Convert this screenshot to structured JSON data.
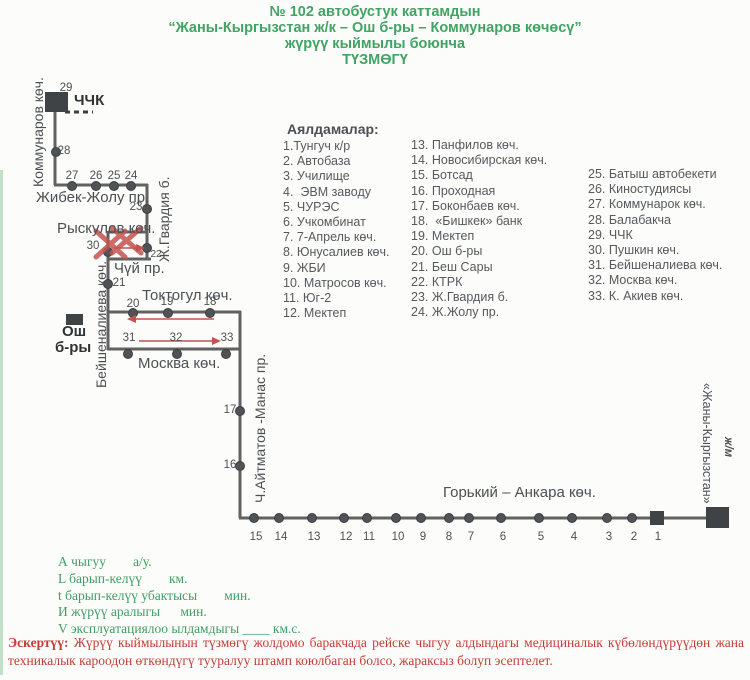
{
  "title": {
    "line1": "№ 102 автобустук каттамдын",
    "line2": "“Жаны-Кыргызстан ж/к – Ош б-ры – Коммунаров көчөсү”",
    "line3": "жүрүү кыймылы боюнча",
    "line4": "ТҮЗМӨГҮ"
  },
  "colors": {
    "title_green": "#3fa464",
    "legend_green": "#3f9e63",
    "note_red": "#c43c36",
    "route_gray": "#616161",
    "mark_red": "#c4524e"
  },
  "stops_header": "Аялдамалар:",
  "stops_col1": [
    "1.Тунгуч к/р",
    "2. Автобаза",
    "3. Училище",
    "4.  ЭВМ заводу",
    "5. ЧУРЭС",
    "6. Учкомбинат",
    "7. 7-Апрель көч.",
    "8. Юнусалиев көч.",
    "9. ЖБИ",
    "10. Матросов көч.",
    "11. Юг-2",
    "12. Мектеп"
  ],
  "stops_col2": [
    "13. Панфилов көч.",
    "14. Новосибирская көч.",
    "15. Ботсад",
    "16. Проходная",
    "17. Боконбаев көч.",
    "18.  «Бишкек» банк",
    "19. Мектеп",
    "20. Ош б-ры",
    "21. Беш Сары",
    "22. КТРК",
    "23. Ж.Гвардия б.",
    "24. Ж.Жолу пр."
  ],
  "stops_col3": [
    "25. Батыш автобекети",
    "26. Киностудиясы",
    "27. Коммунарок көч.",
    "28. Балабакча",
    "29. ЧЧК",
    "30. Пушкин көч.",
    "31. Бейшеналиева көч.",
    "32. Москва көч.",
    "33. К. Акиев көч."
  ],
  "map_labels": [
    {
      "t": "29",
      "x": 66,
      "y": 82,
      "c": "num"
    },
    {
      "t": "ЧЧК",
      "x": 74,
      "y": 92,
      "c": "terminal",
      "n": "terminal-label-chchk"
    },
    {
      "t": "28",
      "x": 64,
      "y": 145,
      "c": "num"
    },
    {
      "t": "27",
      "x": 72,
      "y": 170,
      "c": "num"
    },
    {
      "t": "26",
      "x": 96,
      "y": 170,
      "c": "num"
    },
    {
      "t": "25",
      "x": 114,
      "y": 170,
      "c": "num"
    },
    {
      "t": "24",
      "x": 131,
      "y": 170,
      "c": "num"
    },
    {
      "t": "Жибек-Жолу пр.",
      "x": 36,
      "y": 189,
      "c": "street",
      "n": "street-label-zhibek-zholu"
    },
    {
      "t": "23",
      "x": 136,
      "y": 201,
      "c": "num"
    },
    {
      "t": "Рыскулов көч.",
      "x": 57,
      "y": 220,
      "c": "street",
      "n": "street-label-ryskulov"
    },
    {
      "t": "30",
      "x": 93,
      "y": 240,
      "c": "num"
    },
    {
      "t": "22",
      "x": 156,
      "y": 249,
      "c": "num num-sm"
    },
    {
      "t": "Чүй пр.",
      "x": 114,
      "y": 260,
      "c": "street",
      "n": "street-label-chuy"
    },
    {
      "t": "21",
      "x": 119,
      "y": 277,
      "c": "num"
    },
    {
      "t": "Токтогул көч.",
      "x": 142,
      "y": 287,
      "c": "street",
      "n": "street-label-toktogul"
    },
    {
      "t": "20",
      "x": 133,
      "y": 298,
      "c": "num"
    },
    {
      "t": "19",
      "x": 167,
      "y": 296,
      "c": "num"
    },
    {
      "t": "18",
      "x": 210,
      "y": 296,
      "c": "num"
    },
    {
      "t": "31",
      "x": 129,
      "y": 332,
      "c": "num"
    },
    {
      "t": "32",
      "x": 176,
      "y": 332,
      "c": "num"
    },
    {
      "t": "33",
      "x": 227,
      "y": 332,
      "c": "num"
    },
    {
      "t": "Ош",
      "x": 62,
      "y": 323,
      "c": "terminal",
      "n": "terminal-label-osh"
    },
    {
      "t": "б-ры",
      "x": 55,
      "y": 339,
      "c": "terminal",
      "n": "terminal-label-osh-2"
    },
    {
      "t": "Москва көч.",
      "x": 138,
      "y": 355,
      "c": "street",
      "n": "street-label-moskva"
    },
    {
      "t": "17",
      "x": 230,
      "y": 404,
      "c": "num"
    },
    {
      "t": "16",
      "x": 230,
      "y": 459,
      "c": "num"
    },
    {
      "t": "Горький – Анкара көч.",
      "x": 443,
      "y": 484,
      "c": "street",
      "n": "street-label-gorky-ankara"
    },
    {
      "t": "15",
      "x": 256,
      "y": 531,
      "c": "num"
    },
    {
      "t": "14",
      "x": 281,
      "y": 531,
      "c": "num"
    },
    {
      "t": "13",
      "x": 314,
      "y": 531,
      "c": "num"
    },
    {
      "t": "12",
      "x": 346,
      "y": 531,
      "c": "num"
    },
    {
      "t": "11",
      "x": 369,
      "y": 531,
      "c": "num"
    },
    {
      "t": "10",
      "x": 398,
      "y": 531,
      "c": "num"
    },
    {
      "t": "9",
      "x": 423,
      "y": 531,
      "c": "num"
    },
    {
      "t": "8",
      "x": 449,
      "y": 531,
      "c": "num"
    },
    {
      "t": "7",
      "x": 471,
      "y": 531,
      "c": "num"
    },
    {
      "t": "6",
      "x": 503,
      "y": 531,
      "c": "num"
    },
    {
      "t": "5",
      "x": 541,
      "y": 531,
      "c": "num"
    },
    {
      "t": "4",
      "x": 574,
      "y": 531,
      "c": "num"
    },
    {
      "t": "3",
      "x": 609,
      "y": 531,
      "c": "num"
    },
    {
      "t": "2",
      "x": 634,
      "y": 531,
      "c": "num"
    },
    {
      "t": "1",
      "x": 658,
      "y": 531,
      "c": "num"
    },
    {
      "t": "Коммунаров көч.",
      "x": 30,
      "y": 187,
      "c": "vstreet",
      "r": -90,
      "n": "street-label-kommunarov"
    },
    {
      "t": "Ж.Гвардия б.",
      "x": 156,
      "y": 262,
      "c": "vstreet",
      "r": -90,
      "n": "street-label-gvardiya"
    },
    {
      "t": "Бейшеналиева көч.",
      "x": 93,
      "y": 388,
      "c": "vstreet",
      "r": -90,
      "n": "street-label-beyshenalieva"
    },
    {
      "t": "Ч.Айтматов -Манас пр.",
      "x": 252,
      "y": 503,
      "c": "vstreet",
      "r": -90,
      "n": "street-label-aytmatov-manas"
    },
    {
      "t": "«Жаны-Кыргызстан»",
      "x": 714,
      "y": 383,
      "c": "vstreet vsm",
      "r": 90,
      "n": "terminal-label-zhany-kyrgyzstan"
    },
    {
      "t": "ж/м",
      "x": 734,
      "y": 437,
      "c": "vstreet vitalic",
      "r": 90,
      "n": "terminal-label-zhm"
    }
  ],
  "legend_lines": [
    "А чыгуу        а/у.",
    "L барып-келүү        км.",
    "t барып-келүү убактысы        мин.",
    "И жүрүү аралыгы      мин.",
    "V эксплуатациялоо ылдамдыгы ____ км.с."
  ],
  "note": {
    "label": "Эскертүү:",
    "text": " Жүрүү кыймылынын түзмөгү жолдомо баракчада рейске чыгуу алдындагы медициналык күбөлөндүрүүдөн жана техникалык кароодон өткөндүгү тууралуу штамп коюлбаган болсо, жараксыз болуп эсептелет."
  }
}
